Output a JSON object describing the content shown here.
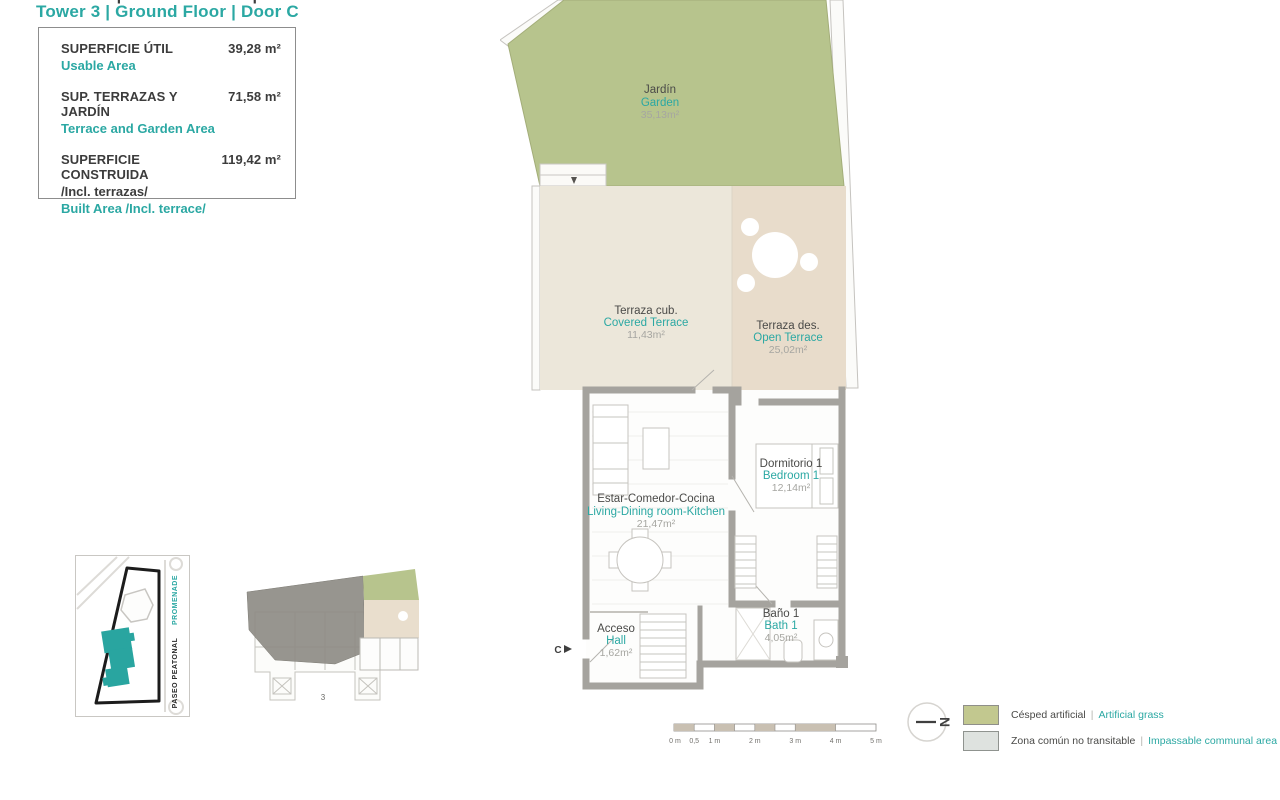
{
  "header": {
    "title_es": "TORRE 3 | PLANTA BAJA | PUERTA C",
    "title_en": "Tower 3 | Ground Floor | Door C"
  },
  "info_box": {
    "rows": [
      {
        "label_es": "SUPERFICIE ÚTIL",
        "value": "39,28 m²",
        "label_en": "Usable Area"
      },
      {
        "label_es": "SUP. TERRAZAS Y JARDÍN",
        "value": "71,58 m²",
        "label_en": "Terrace and Garden Area"
      },
      {
        "label_es": "SUPERFICIE CONSTRUIDA",
        "value": "119,42 m²",
        "label_note": "/Incl. terrazas/",
        "label_en": "Built Area /Incl. terrace/"
      }
    ]
  },
  "plan": {
    "rooms": [
      {
        "name_es": "Jardín",
        "name_en": "Garden",
        "area": "35,13m²"
      },
      {
        "name_es": "Terraza cub.",
        "name_en": "Covered Terrace",
        "area": "11,43m²"
      },
      {
        "name_es": "Terraza des.",
        "name_en": "Open Terrace",
        "area": "25,02m²"
      },
      {
        "name_es": "Estar-Comedor-Cocina",
        "name_en": "Living-Dining room-Kitchen",
        "area": "21,47m²"
      },
      {
        "name_es": "Dormitorio 1",
        "name_en": "Bedroom 1",
        "area": "12,14m²"
      },
      {
        "name_es": "Baño 1",
        "name_en": "Bath 1",
        "area": "4,05m²"
      },
      {
        "name_es": "Acceso",
        "name_en": "Hall",
        "area": "1,62m²"
      }
    ],
    "door_label": "C"
  },
  "site_map": {
    "street_es": "PASEO PEATONAL",
    "street_en": "PROMENADE"
  },
  "key_plan": {
    "label": "3"
  },
  "scale_bar": {
    "labels": [
      "0 m",
      "0,5",
      "1 m",
      "2 m",
      "3 m",
      "4 m",
      "5 m"
    ]
  },
  "compass": {
    "label": "N"
  },
  "legend": {
    "items": [
      {
        "swatch": "#c2c88f",
        "label_es": "Césped artificial",
        "label_en": "Artificial grass"
      },
      {
        "swatch": "#dee2df",
        "label_es": "Zona común no transitable",
        "label_en": "Impassable communal area"
      }
    ]
  },
  "colors": {
    "accent_teal": "#2ba8a3",
    "garden_green": "#b7c48d",
    "covered_terrace": "#ece7da",
    "open_terrace": "#e8dccb",
    "wall_gray": "#a5a39e"
  }
}
